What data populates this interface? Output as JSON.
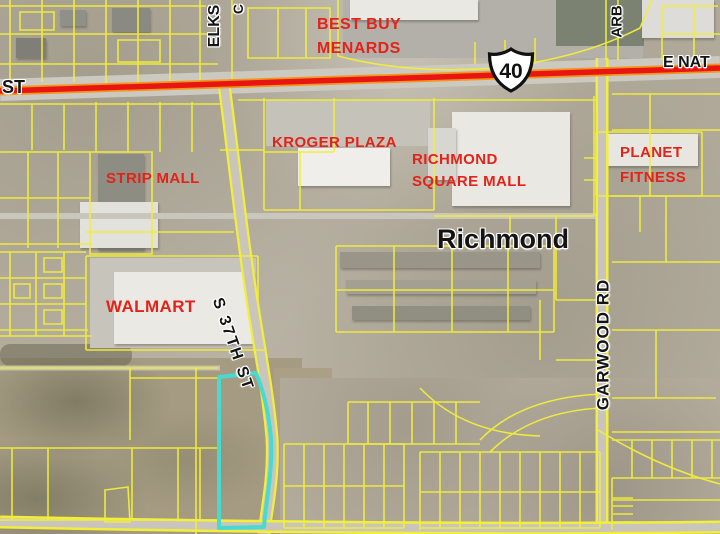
{
  "map": {
    "description": "Aerial parcel map of Richmond retail corridor with a highlighted parcel along S 37th St",
    "city_label": "Richmond",
    "shield": {
      "route": "40"
    },
    "streets": {
      "st_partial": "ST",
      "e_national_partial": "E NAT",
      "elks": "ELKS",
      "elks_second": "C",
      "arba_partial": "ARB",
      "s_37th": "S 37TH ST",
      "garwood": "GARWOOD RD"
    },
    "pois": {
      "best_buy": "BEST BUY",
      "menards": "MENARDS",
      "kroger_plaza": "KROGER PLAZA",
      "richmond_square_line1": "RICHMOND",
      "richmond_square_line2": "SQUARE MALL",
      "planet_line1": "PLANET",
      "planet_line2": "FITNESS",
      "strip_mall": "STRIP MALL",
      "walmart": "WALMART"
    },
    "colors": {
      "poi_label": "#e2231a",
      "parcel_line": "#f2ee3a",
      "highlighted_road": "#e81511",
      "highlighted_parcel": "#48d9d1",
      "street_label": "#141414"
    }
  }
}
